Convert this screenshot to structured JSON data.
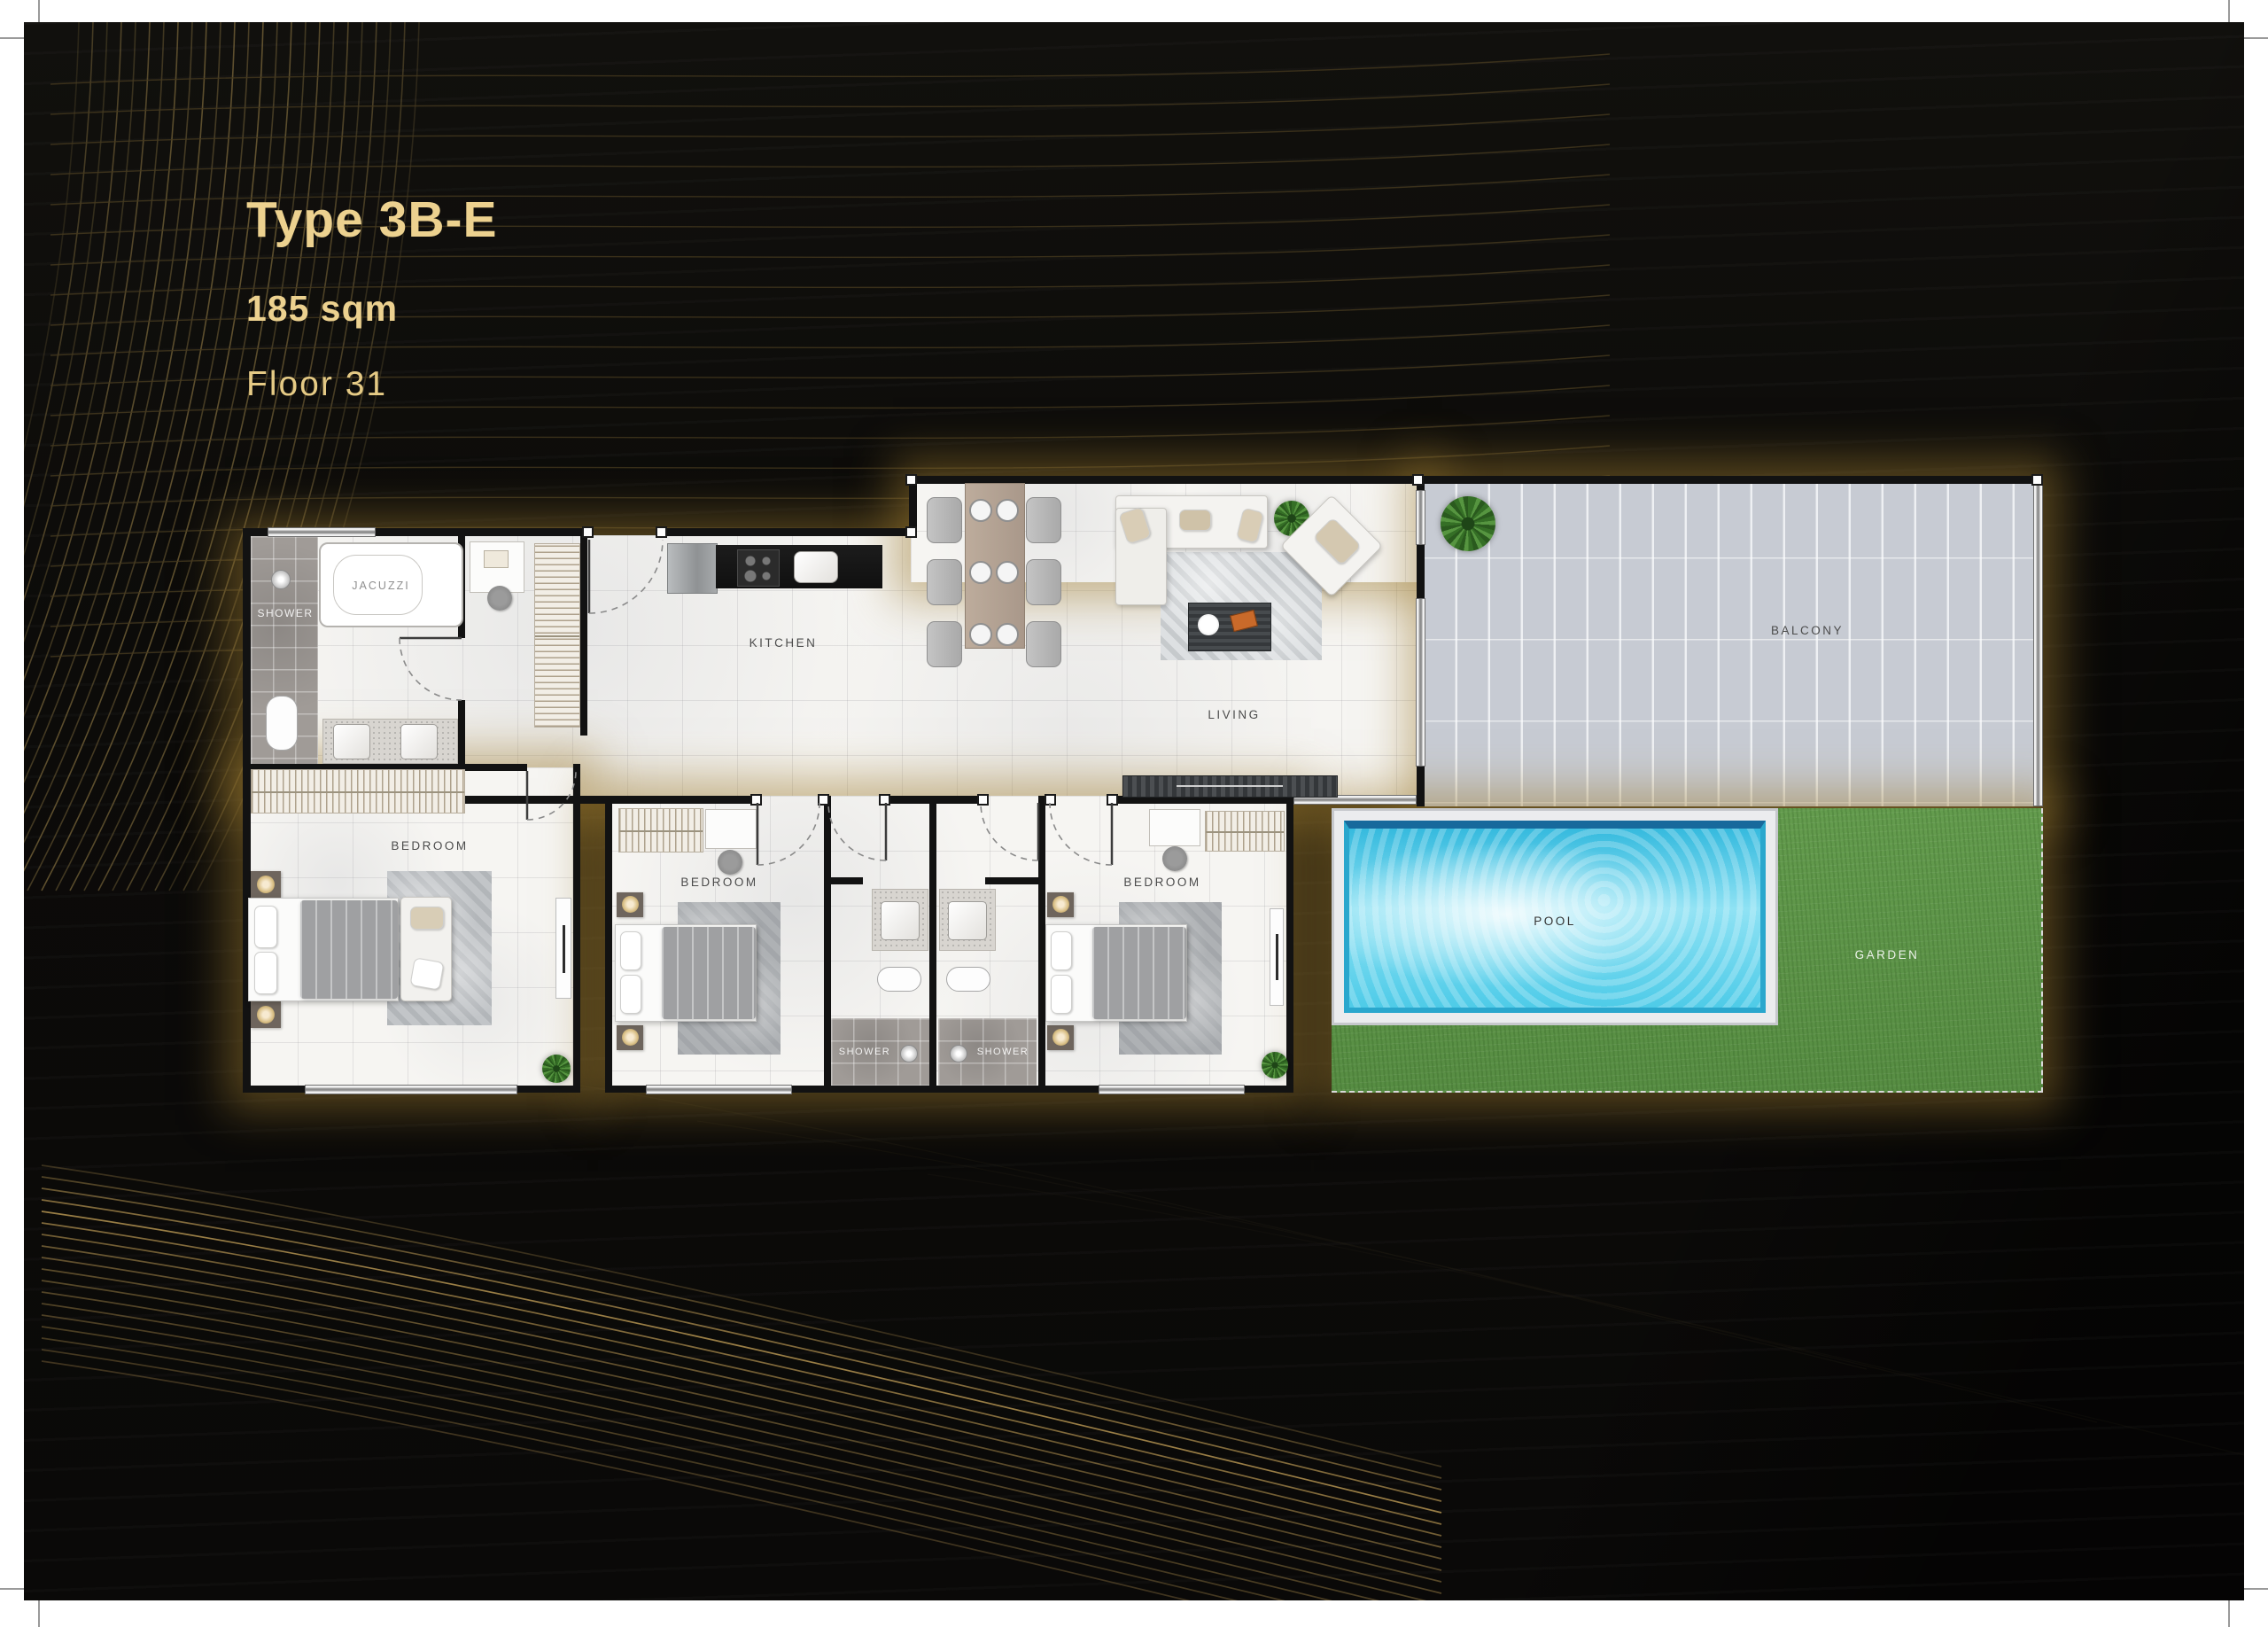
{
  "page": {
    "title": "Type 3B-E",
    "area": "185 sqm",
    "floor": "Floor 31",
    "accent_color": "#ecd18f",
    "background_color": "#0c0b09"
  },
  "floorplan": {
    "labels": {
      "kitchen": "KITCHEN",
      "living": "LIVING",
      "balcony": "BALCONY",
      "pool": "POOL",
      "garden": "GARDEN",
      "bedroom": "BEDROOM",
      "shower": "SHOWER",
      "jacuzzi": "JACUZZI"
    },
    "colors": {
      "pool_water": "#49c9e6",
      "garden_green": "#5f9a4a",
      "balcony_tile": "#c9cdd5",
      "wall": "#121212",
      "floor_marble": "#f6f5f2",
      "glow_gold": "#9e7c30"
    }
  }
}
